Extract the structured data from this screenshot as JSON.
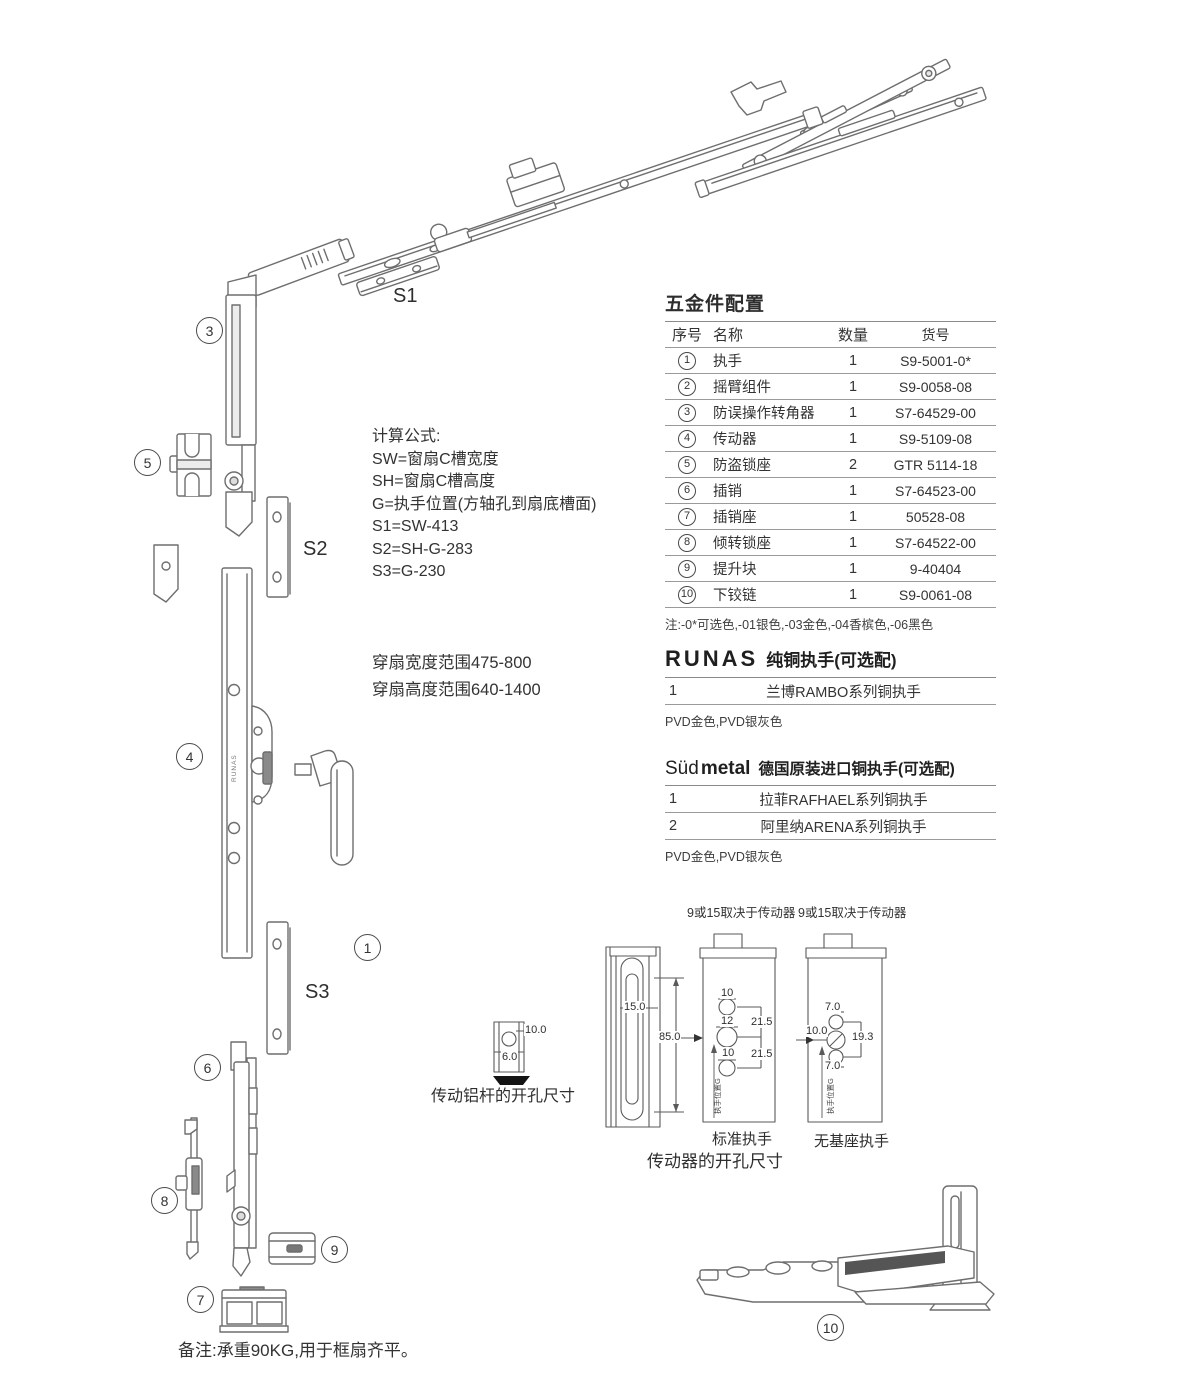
{
  "hardware_table": {
    "title": "五金件配置",
    "headers": {
      "no": "序号",
      "name": "名称",
      "qty": "数量",
      "code": "货号"
    },
    "rows": [
      {
        "no": "1",
        "name": "执手",
        "qty": "1",
        "code": "S9-5001-0*"
      },
      {
        "no": "2",
        "name": "摇臂组件",
        "qty": "1",
        "code": "S9-0058-08"
      },
      {
        "no": "3",
        "name": "防误操作转角器",
        "qty": "1",
        "code": "S7-64529-00"
      },
      {
        "no": "4",
        "name": "传动器",
        "qty": "1",
        "code": "S9-5109-08"
      },
      {
        "no": "5",
        "name": "防盗锁座",
        "qty": "2",
        "code": "GTR 5114-18"
      },
      {
        "no": "6",
        "name": "插销",
        "qty": "1",
        "code": "S7-64523-00"
      },
      {
        "no": "7",
        "name": "插销座",
        "qty": "1",
        "code": "50528-08"
      },
      {
        "no": "8",
        "name": "倾转锁座",
        "qty": "1",
        "code": "S7-64522-00"
      },
      {
        "no": "9",
        "name": "提升块",
        "qty": "1",
        "code": "9-40404"
      },
      {
        "no": "10",
        "name": "下铰链",
        "qty": "1",
        "code": "S9-0061-08"
      }
    ],
    "note": "注:-0*可选色,-01银色,-03金色,-04香槟色,-06黑色"
  },
  "runas": {
    "brand": "RUNAS",
    "title": "纯铜执手(可选配)",
    "rows": [
      {
        "no": "1",
        "name": "兰博RAMBO系列铜执手"
      }
    ],
    "note": "PVD金色,PVD银灰色"
  },
  "sudmetal": {
    "brand_light": "Süd",
    "brand_bold": "metal",
    "title": "德国原装进口铜执手(可选配)",
    "rows": [
      {
        "no": "1",
        "name": "拉菲RAFHAEL系列铜执手"
      },
      {
        "no": "2",
        "name": "阿里纳ARENA系列铜执手"
      }
    ],
    "note": "PVD金色,PVD银灰色"
  },
  "formulas": {
    "title": "计算公式:",
    "lines": [
      "SW=窗扇C槽宽度",
      "SH=窗扇C槽高度",
      "G=执手位置(方轴孔到扇底槽面)",
      "S1=SW-413",
      "S2=SH-G-283",
      "S3=G-230"
    ]
  },
  "ranges": {
    "width_line": "穿扇宽度范围475-800",
    "height_line": "穿扇高度范围640-1400"
  },
  "diagram": {
    "part_labels": [
      "3",
      "5",
      "4",
      "1",
      "6",
      "8",
      "9",
      "7",
      "10"
    ],
    "s_labels": [
      "S1",
      "S2",
      "S3"
    ],
    "bar_brand": "RUNAS"
  },
  "drill_small": {
    "caption": "传动铝杆的开孔尺寸",
    "dim_top": "10.0",
    "dim_side": "6.0"
  },
  "driller": {
    "caption": "传动器的开孔尺寸",
    "header_left": "9或15取决于传动器",
    "header_right": "9或15取决于传动器",
    "profile": {
      "slot_width": "15.0",
      "slot_height": "85.0"
    },
    "standard": {
      "label": "标准执手",
      "hole_top": "10",
      "hole_mid": "12",
      "hole_bottom": "10",
      "pitch_top": "21.5",
      "pitch_bottom": "21.5",
      "pos": "执手位置G"
    },
    "no_base": {
      "label": "无基座执手",
      "dim_top": "7.0",
      "dim_left": "10.0",
      "dim_right": "19.3",
      "dim_bottom": "7.0",
      "pos": "执手位置G"
    }
  },
  "footer": {
    "note": "备注:承重90KG,用于框扇齐平。"
  }
}
